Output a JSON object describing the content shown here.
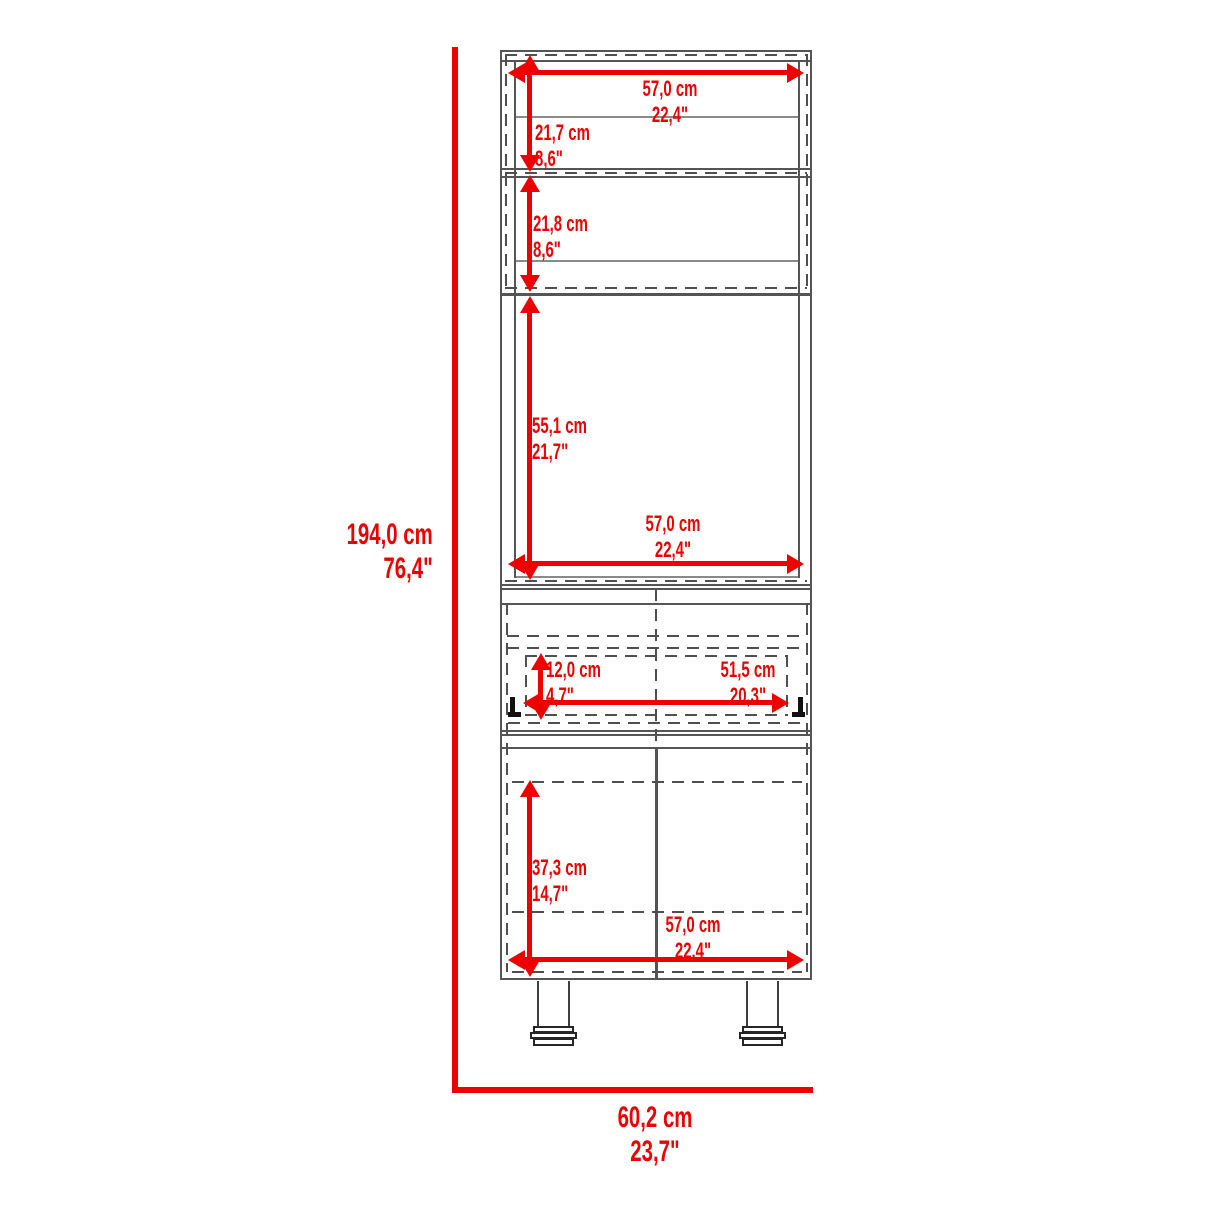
{
  "colors": {
    "accent_red": "#EC0000",
    "line_gray": "#555555",
    "dash_gray": "#4f4f4f"
  },
  "dims": {
    "top_width": {
      "cm": "57,0 cm",
      "in": "22,4\""
    },
    "shelf1_height": {
      "cm": "21,7 cm",
      "in": "8,6\""
    },
    "shelf2_height": {
      "cm": "21,8 cm",
      "in": "8,6\""
    },
    "cavity_height": {
      "cm": "55,1 cm",
      "in": "21,7\""
    },
    "cavity_width": {
      "cm": "57,0 cm",
      "in": "22,4\""
    },
    "drawer_height": {
      "cm": "12,0 cm",
      "in": "4,7\""
    },
    "drawer_width": {
      "cm": "51,5 cm",
      "in": "20,3\""
    },
    "door_height": {
      "cm": "37,3 cm",
      "in": "14,7\""
    },
    "base_width": {
      "cm": "57,0 cm",
      "in": "22,4\""
    },
    "overall_height": {
      "cm": "194,0 cm",
      "in": "76,4\""
    },
    "overall_width": {
      "cm": "60,2 cm",
      "in": "23,7\""
    }
  }
}
